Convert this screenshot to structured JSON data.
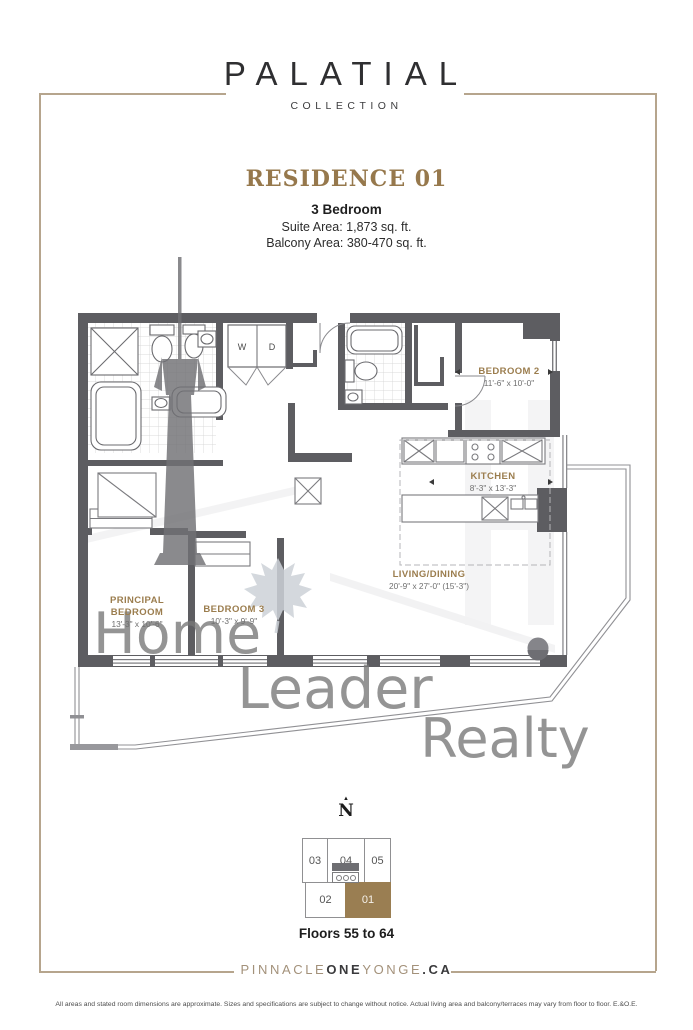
{
  "header": {
    "brand": "PALATIAL",
    "collection": "COLLECTION"
  },
  "residence": {
    "title": "RESIDENCE 01",
    "type": "3 Bedroom",
    "suite_area": "Suite Area: 1,873 sq. ft.",
    "balcony_area": "Balcony Area: 380-470 sq. ft."
  },
  "floorplan": {
    "rooms": [
      {
        "name": "BEDROOM 2",
        "dims": "11'-6\" x 10'-0\""
      },
      {
        "name": "KITCHEN",
        "dims": "8'-3\" x 13'-3\""
      },
      {
        "name": "LIVING/DINING",
        "dims": "20'-9\" x 27'-0\" (15'-3\")"
      },
      {
        "name_lines": [
          "PRINCIPAL",
          "BEDROOM"
        ],
        "dims": "13'-3\" x 10'-6\""
      },
      {
        "name": "BEDROOM 3",
        "dims": "10'-3\" x 9'-9\""
      }
    ],
    "appliances": {
      "washer": "W",
      "dryer": "D"
    },
    "watermark": {
      "lines": [
        "Home",
        "Leader",
        "Realty"
      ]
    },
    "colors": {
      "wall": "#5d5d61",
      "room_label": "#9b7d4e",
      "dimension": "#6f6f6f",
      "watermark_text": "#8c8c8c"
    }
  },
  "keyplan": {
    "north": "N",
    "units": [
      "03",
      "04",
      "05",
      "02",
      "01"
    ],
    "highlighted_unit": "01",
    "highlight_color": "#9a7e52",
    "floors": "Floors 55 to 64"
  },
  "footer": {
    "website_segments": [
      {
        "text": "PINNACLE",
        "color": "#a3917a"
      },
      {
        "text": "ONE",
        "color": "#3a3a3c"
      },
      {
        "text": "YONGE",
        "color": "#a3917a"
      },
      {
        "text": ".CA",
        "color": "#3a3a3c"
      }
    ],
    "disclaimer": "All areas and stated room dimensions are approximate. Sizes and specifications are subject to change without notice. Actual living area and balcony/terraces may vary from floor to floor. E.&O.E."
  }
}
